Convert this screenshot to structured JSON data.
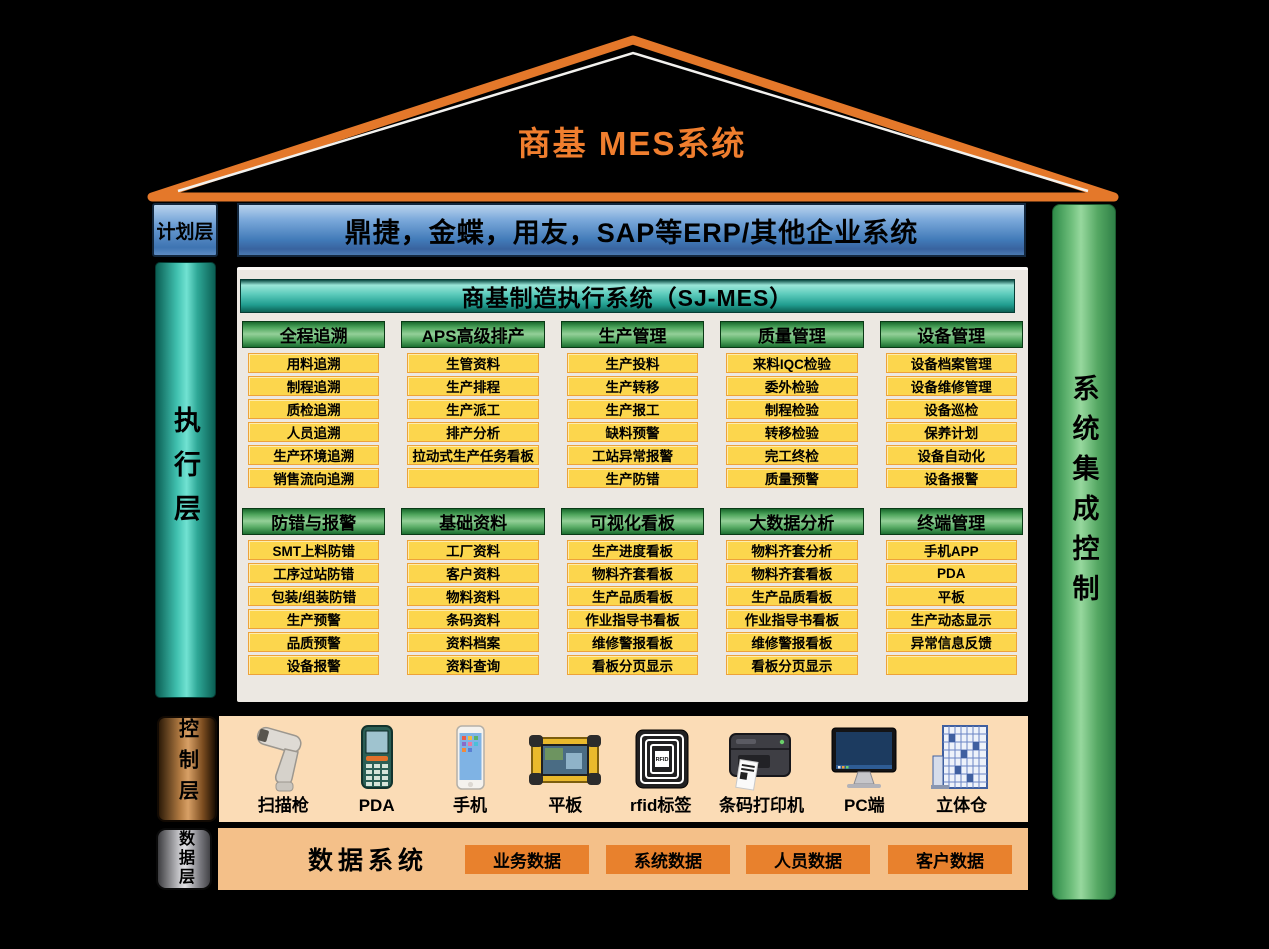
{
  "roof": {
    "title": "商基  MES系统"
  },
  "plan_layer": {
    "label": "计划层",
    "erp_text": "鼎捷，金蝶，用友，SAP等ERP/其他企业系统"
  },
  "execution_layer": {
    "label": "执行层",
    "header": "商基制造执行系统（SJ-MES）",
    "modules": [
      {
        "title": "全程追溯",
        "items": [
          "用料追溯",
          "制程追溯",
          "质检追溯",
          "人员追溯",
          "生产环境追溯",
          "销售流向追溯"
        ]
      },
      {
        "title": "APS高级排产",
        "items": [
          "生管资料",
          "生产排程",
          "生产派工",
          "排产分析",
          "拉动式生产任务看板",
          ""
        ]
      },
      {
        "title": "生产管理",
        "items": [
          "生产投料",
          "生产转移",
          "生产报工",
          "缺料预警",
          "工站异常报警",
          "生产防错"
        ]
      },
      {
        "title": "质量管理",
        "items": [
          "来料IQC检验",
          "委外检验",
          "制程检验",
          "转移检验",
          "完工终检",
          "质量预警"
        ]
      },
      {
        "title": "设备管理",
        "items": [
          "设备档案管理",
          "设备维修管理",
          "设备巡检",
          "保养计划",
          "设备自动化",
          "设备报警"
        ]
      },
      {
        "title": "防错与报警",
        "items": [
          "SMT上料防错",
          "工序过站防错",
          "包装/组装防错",
          "生产预警",
          "品质预警",
          "设备报警"
        ]
      },
      {
        "title": "基础资料",
        "items": [
          "工厂资料",
          "客户资料",
          "物料资料",
          "条码资料",
          "资料档案",
          "资料查询"
        ]
      },
      {
        "title": "可视化看板",
        "items": [
          "生产进度看板",
          "物料齐套看板",
          "生产品质看板",
          "作业指导书看板",
          "维修警报看板",
          "看板分页显示"
        ]
      },
      {
        "title": "大数据分析",
        "items": [
          "物料齐套分析",
          "物料齐套看板",
          "生产品质看板",
          "作业指导书看板",
          "维修警报看板",
          "看板分页显示"
        ]
      },
      {
        "title": "终端管理",
        "items": [
          "手机APP",
          "PDA",
          "平板",
          "生产动态显示",
          "异常信息反馈",
          ""
        ]
      }
    ]
  },
  "control_layer": {
    "label": "控制层",
    "devices": [
      {
        "label": "扫描枪",
        "icon": "barcode-scanner-icon"
      },
      {
        "label": "PDA",
        "icon": "pda-icon"
      },
      {
        "label": "手机",
        "icon": "phone-icon"
      },
      {
        "label": "平板",
        "icon": "tablet-icon"
      },
      {
        "label": "rfid标签",
        "icon": "rfid-tag-icon"
      },
      {
        "label": "条码打印机",
        "icon": "barcode-printer-icon"
      },
      {
        "label": "PC端",
        "icon": "pc-monitor-icon"
      },
      {
        "label": "立体仓",
        "icon": "warehouse-icon"
      }
    ]
  },
  "data_layer": {
    "label": "数据层",
    "title": "数据系统",
    "databases": [
      "业务数据",
      "系统数据",
      "人员数据",
      "客户数据"
    ]
  },
  "right_bar": {
    "label": "系统集成控制"
  },
  "colors": {
    "roof_orange": "#E4782A",
    "title_orange": "#F07E2E",
    "erp_blue": "#417AB8",
    "exec_teal": "#2FA897",
    "module_green": "#4EA55C",
    "item_yellow": "#FCD64D",
    "control_band_peach": "#FBDCB6",
    "data_band_orange": "#F4C089",
    "database_orange": "#E8812D",
    "integration_green": "#55A863"
  }
}
